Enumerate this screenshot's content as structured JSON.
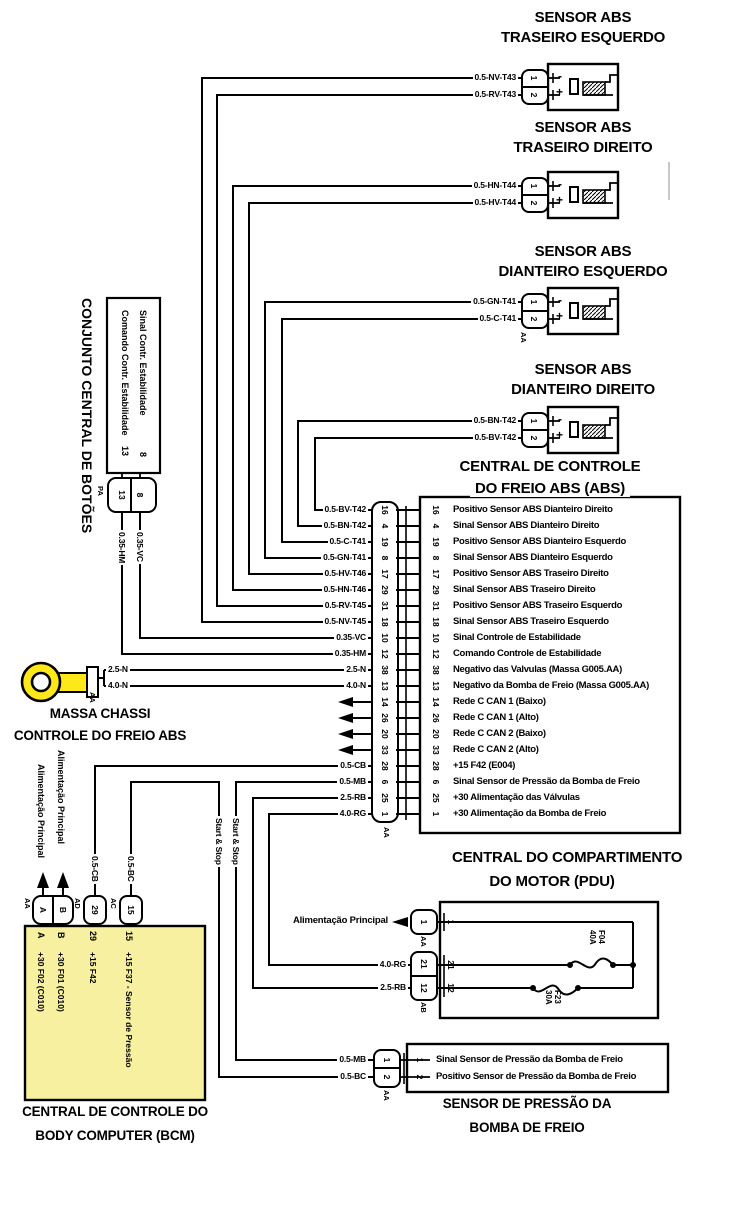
{
  "colors": {
    "module_fill": "#f6f0a0",
    "ground_terminal_fill": "#ffe81a",
    "line": "#000000"
  },
  "sensors": [
    {
      "title1": "SENSOR ABS",
      "title2": "TRASEIRO ESQUERDO",
      "wire1": "0.5-NV-T43",
      "wire2": "0.5-RV-T43",
      "pin1": "1",
      "pin2": "2",
      "neg": "-",
      "pos": "+"
    },
    {
      "title1": "SENSOR ABS",
      "title2": "TRASEIRO DIREITO",
      "wire1": "0.5-HN-T44",
      "wire2": "0.5-HV-T44",
      "pin1": "1",
      "pin2": "2",
      "neg": "-",
      "pos": "+"
    },
    {
      "title1": "SENSOR ABS",
      "title2": "DIANTEIRO ESQUERDO",
      "wire1": "0.5-GN-T41",
      "wire2": "0.5-C-T41",
      "pin1": "1",
      "pin2": "2",
      "neg": "-",
      "pos": "+",
      "code": "AA"
    },
    {
      "title1": "SENSOR ABS",
      "title2": "DIANTEIRO DIREITO",
      "wire1": "0.5-BN-T42",
      "wire2": "0.5-BV-T42",
      "pin1": "1",
      "pin2": "2",
      "neg": "-",
      "pos": "+"
    }
  ],
  "abs": {
    "title1": "CENTRAL DE CONTROLE",
    "title2": "DO FREIO ABS (ABS)",
    "code": "AA",
    "ae_label": "Arquitetura Eletrônica",
    "rows": [
      {
        "wire": "0.5-BV-T42",
        "pin": "16",
        "desc": "Positivo Sensor ABS Dianteiro Direito"
      },
      {
        "wire": "0.5-BN-T42",
        "pin": "4",
        "desc": "Sinal Sensor ABS Dianteiro Direito"
      },
      {
        "wire": "0.5-C-T41",
        "pin": "19",
        "desc": "Positivo Sensor ABS Dianteiro Esquerdo"
      },
      {
        "wire": "0.5-GN-T41",
        "pin": "8",
        "desc": "Sinal Sensor ABS Dianteiro Esquerdo"
      },
      {
        "wire": "0.5-HV-T46",
        "pin": "17",
        "desc": "Positivo Sensor ABS Traseiro Direito"
      },
      {
        "wire": "0.5-HN-T46",
        "pin": "29",
        "desc": "Sinal Sensor ABS Traseiro Direito"
      },
      {
        "wire": "0.5-RV-T45",
        "pin": "31",
        "desc": "Positivo Sensor ABS Traseiro Esquerdo"
      },
      {
        "wire": "0.5-NV-T45",
        "pin": "18",
        "desc": "Sinal Sensor ABS Traseiro Esquerdo"
      },
      {
        "wire": "0.35-VC",
        "pin": "10",
        "desc": "Sinal Controle de Estabilidade"
      },
      {
        "wire": "0.35-HM",
        "pin": "12",
        "desc": "Comando Controle de Estabilidade"
      },
      {
        "wire": "2.5-N",
        "pin": "38",
        "desc": "Negativo das Valvulas (Massa G005.AA)"
      },
      {
        "wire": "4.0-N",
        "pin": "13",
        "desc": "Negativo da Bomba de Freio (Massa G005.AA)"
      },
      {
        "ae": true,
        "pin": "14",
        "desc": "Rede C CAN 1  (Baixo)"
      },
      {
        "ae": true,
        "pin": "26",
        "desc": "Rede C CAN 1  (Alto)"
      },
      {
        "ae": true,
        "pin": "20",
        "desc": "Rede C CAN 2  (Baixo)"
      },
      {
        "ae": true,
        "pin": "33",
        "desc": "Rede C CAN 2  (Alto)"
      },
      {
        "wire": "0.5-CB",
        "pin": "28",
        "desc": "+15 F42 (E004)"
      },
      {
        "wire": "0.5-MB",
        "pin": "6",
        "desc": "Sinal Sensor de Pressão da Bomba de Freio"
      },
      {
        "wire": "2.5-RB",
        "pin": "25",
        "desc": "+30 Alimentação das Válvulas"
      },
      {
        "wire": "4.0-RG",
        "pin": "1",
        "desc": "+30 Alimentação da Bomba de Freio"
      }
    ]
  },
  "botoes": {
    "title": "CONJUNTO CENTRAL DE BOTÕES",
    "sig1": "Sinal Contr. Estabilidade",
    "sig1_pin": "8",
    "sig2": "Comando Contr. Estabilidade",
    "sig2_pin": "13",
    "code": "PA",
    "conn_pin_left": "13",
    "conn_pin_right": "8",
    "wire_left": "0.35-HM",
    "wire_right": "0.35-VC"
  },
  "massa": {
    "wire1": "2.5-N",
    "wire2": "4.0-N",
    "code": "AA",
    "cap1": "MASSA CHASSI",
    "cap2": "CONTROLE DO FREIO ABS"
  },
  "bcm": {
    "feed1": "Alimentação Principal",
    "feed2": "Alimentação Principal",
    "code_ab": "AA",
    "code_29": "AD",
    "code_15": "AC",
    "conn_a": "A",
    "conn_b": "B",
    "conn_29": "29",
    "conn_15": "15",
    "wire29": "0.5-CB",
    "wire15": "0.5-BC",
    "startstop1": "Start & Stop",
    "startstop2": "Start & Stop",
    "cols": [
      {
        "pin": "A",
        "desc": "+30 F02 (C010)"
      },
      {
        "pin": "B",
        "desc": "+30 F01 (C010)"
      },
      {
        "pin": "29",
        "desc": "+15 F42"
      },
      {
        "pin": "15",
        "desc": "+15 F37 - Sensor de Pressão"
      }
    ],
    "cap1": "CENTRAL DE CONTROLE DO",
    "cap2": "BODY COMPUTER (BCM)"
  },
  "pdu": {
    "title1": "CENTRAL DO COMPARTIMENTO",
    "title2": "DO MOTOR (PDU)",
    "feed": "Alimentação Principal",
    "code1": "AA",
    "code2": "AB",
    "pin1": "1",
    "pin21": "21",
    "pin12": "12",
    "wire21": "4.0-RG",
    "wire12": "2.5-RB",
    "fuse1_name": "F04",
    "fuse1_amp": "40A",
    "fuse2_name": "F23",
    "fuse2_amp": "30A"
  },
  "pressao": {
    "rows": [
      {
        "wire": "0.5-MB",
        "pin": "1",
        "desc": "Sinal Sensor de Pressão da Bomba de Freio"
      },
      {
        "wire": "0.5-BC",
        "pin": "2",
        "desc": "Positivo Sensor de Pressão da Bomba de Freio"
      }
    ],
    "code": "AA",
    "cap1": "SENSOR DE PRESSÃO DA",
    "cap2": "BOMBA DE FREIO"
  }
}
